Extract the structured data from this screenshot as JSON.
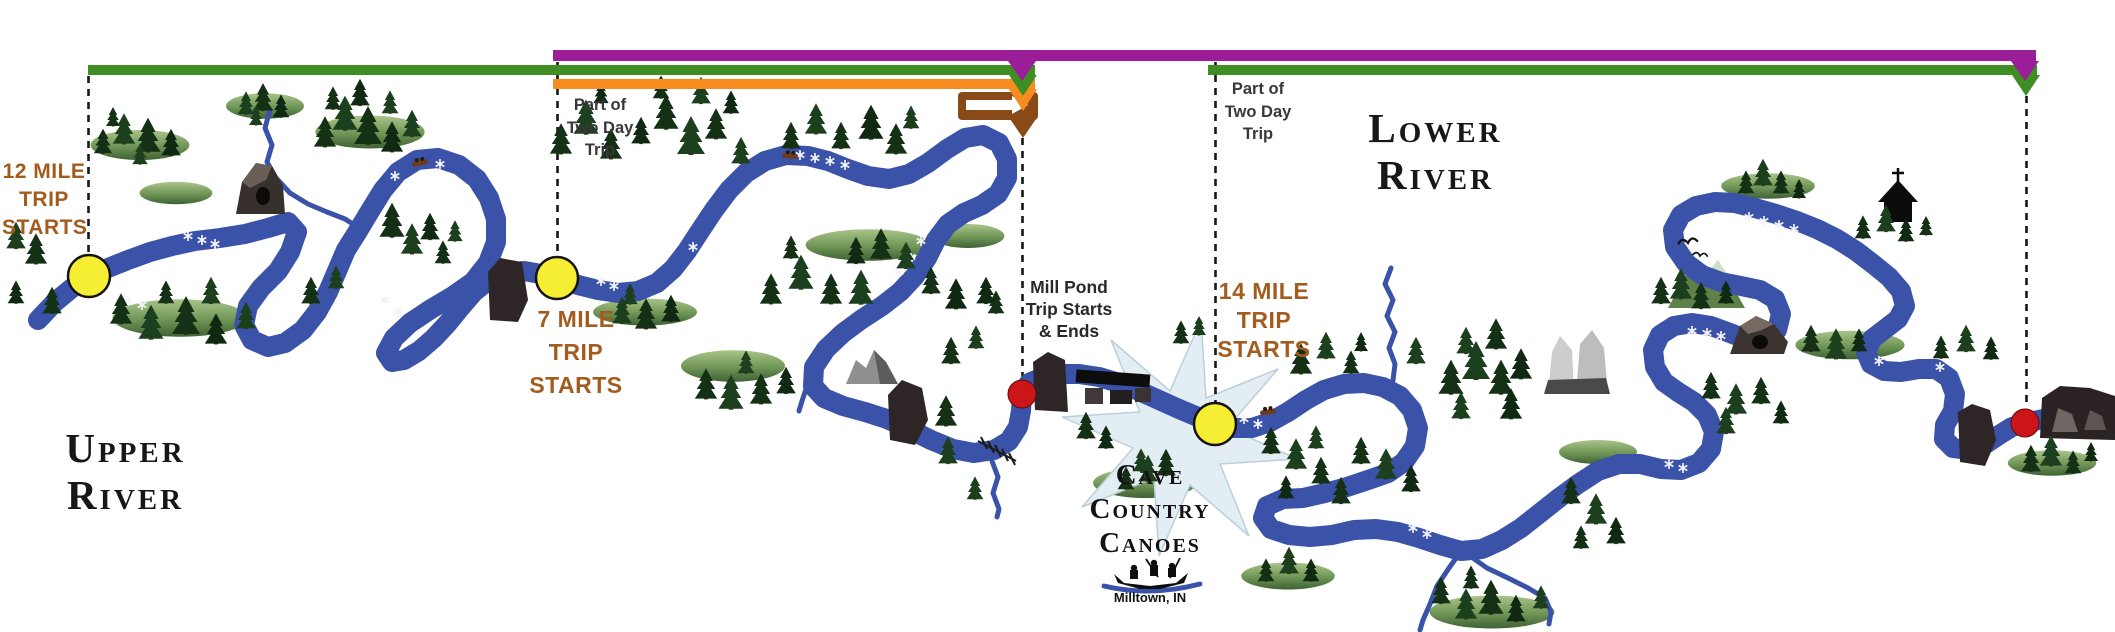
{
  "map": {
    "width": 2115,
    "height": 632,
    "region_titles": {
      "upper": {
        "line1": "Upper",
        "line2": "River"
      },
      "lower": {
        "line1": "Lower",
        "line2": "River"
      }
    },
    "outfitter": {
      "line1": "Cave",
      "line2": "Country",
      "line3": "Canoes",
      "location": "Milltown, IN"
    },
    "trip_labels": {
      "trip12": {
        "line1": "12 MILE",
        "line2": "TRIP",
        "line3": "STARTS"
      },
      "trip7": {
        "line1": "7 MILE",
        "line2": "TRIP",
        "line3": "STARTS"
      },
      "trip14": {
        "line1": "14 MILE",
        "line2": "TRIP",
        "line3": "STARTS"
      },
      "millpond": {
        "line1": "Mill Pond",
        "line2": "Trip Starts",
        "line3": "& Ends"
      },
      "twoday_left": {
        "line1": "Part of",
        "line2": "Two Day",
        "line3": "Trip"
      },
      "twoday_right": {
        "line1": "Part of",
        "line2": "Two Day",
        "line3": "Trip"
      }
    },
    "routes": {
      "two_day": {
        "id": "two-day-trip-bar",
        "color": "#9c1d98"
      },
      "mile12": {
        "id": "12-mile-trip-bar",
        "color": "#3f8e24"
      },
      "mile7": {
        "id": "7-mile-trip-bar",
        "color": "#f78d1e"
      },
      "mile14": {
        "id": "14-mile-trip-bar",
        "color": "#3f8e24"
      },
      "millpond": {
        "id": "mill-pond-trip-bar",
        "color": "#8a4a18"
      }
    },
    "colors": {
      "river": "#3a53a9",
      "start_marker": "#f5ee33",
      "end_marker": "#cb1517",
      "trip_text": "#a35c1e",
      "map_text": "#39373a"
    }
  }
}
